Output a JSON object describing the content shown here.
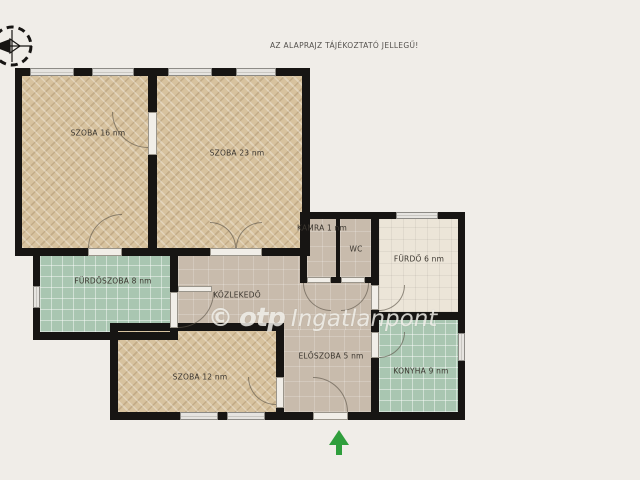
{
  "header": {
    "disclaimer": "AZ ALAPRAJZ TÁJÉKOZTATÓ JELLEGŰ!"
  },
  "watermark": {
    "symbol": "©",
    "brand": "otp",
    "name": "Ingatlanpont"
  },
  "rooms": [
    {
      "id": "szoba16",
      "label": "SZOBA 16 nm",
      "floor": "wood"
    },
    {
      "id": "szoba23",
      "label": "SZOBA 23 nm",
      "floor": "wood"
    },
    {
      "id": "furdoszoba",
      "label": "FÜRDŐSZOBA 8 nm",
      "floor": "green-tile"
    },
    {
      "id": "kozlekedo",
      "label": "KÖZLEKEDŐ",
      "floor": "screed"
    },
    {
      "id": "kamra",
      "label": "KAMRA 1 nm",
      "floor": "screed"
    },
    {
      "id": "wc",
      "label": "WC",
      "floor": "screed"
    },
    {
      "id": "furdo",
      "label": "FÜRDŐ 6 nm",
      "floor": "cream"
    },
    {
      "id": "szoba12",
      "label": "SZOBA 12 nm",
      "floor": "wood"
    },
    {
      "id": "eloszoba",
      "label": "ELŐSZOBA 5 nm",
      "floor": "screed"
    },
    {
      "id": "konyha",
      "label": "KONYHA 9 nm",
      "floor": "green-tile"
    }
  ],
  "colors": {
    "background": "#f0ede8",
    "wall": "#171513",
    "wood_floor": "#d7c29e",
    "green_tile": "#a9c6b1",
    "screed_floor": "#c8bbac",
    "cream_floor": "#ece5d8",
    "entrance_arrow": "#2f9e3c"
  }
}
